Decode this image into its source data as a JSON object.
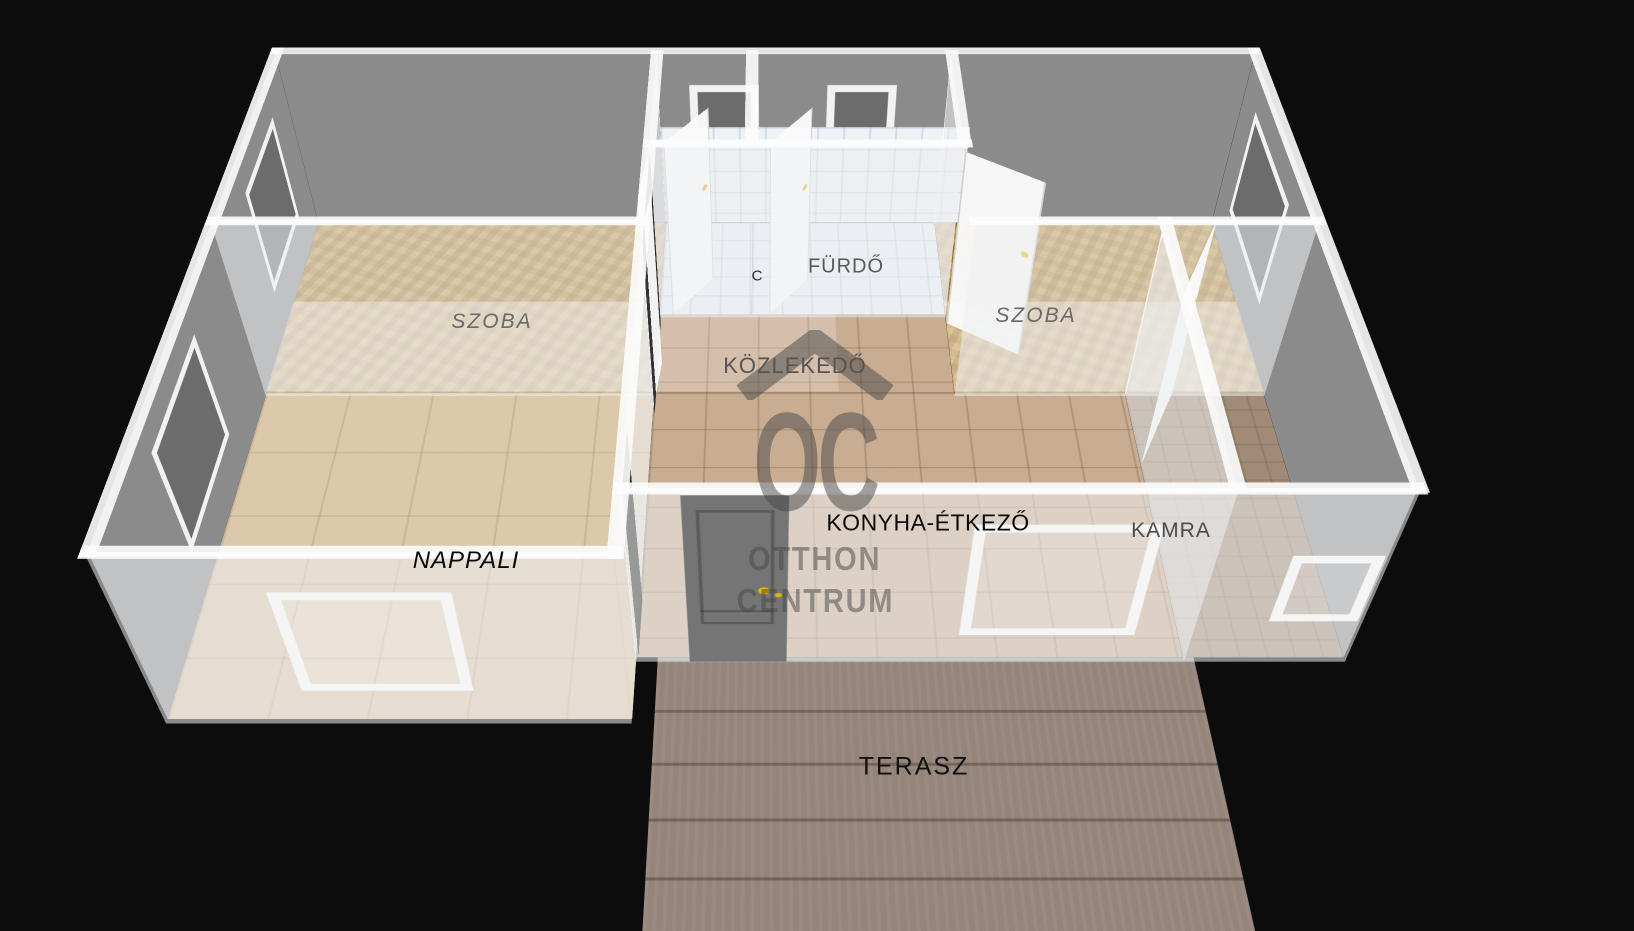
{
  "rooms": {
    "szoba_left": "SZOBA",
    "szoba_right": "SZOBA",
    "wc_partial": "C",
    "furdo": "FÜRDŐ",
    "kozlekedo": "KÖZLEKEDŐ",
    "nappali": "NAPPALI",
    "konyha_etkezo": "KONYHA-ÉTKEZŐ",
    "kamra": "KAMRA",
    "terasz": "TERASZ"
  },
  "watermark": {
    "initials": "OC",
    "line1": "OTTHON",
    "line2": "CENTRUM"
  },
  "colors": {
    "background": "#0c0c0c",
    "wall_gray": "#8b8b8b",
    "wall_glass": "rgba(236,239,241,0.55)",
    "wood_floor": "#b5873a",
    "tile_white": "#e9edf3",
    "tile_beige": "#c9ad92",
    "tile_tan": "#dcc8ab",
    "kamra_floor": "#a18b76",
    "terrace_stone": "#95847a",
    "door_gray": "#757575",
    "handle_gold": "#e8b413",
    "watermark_gray": "rgba(70,70,70,0.5)"
  }
}
